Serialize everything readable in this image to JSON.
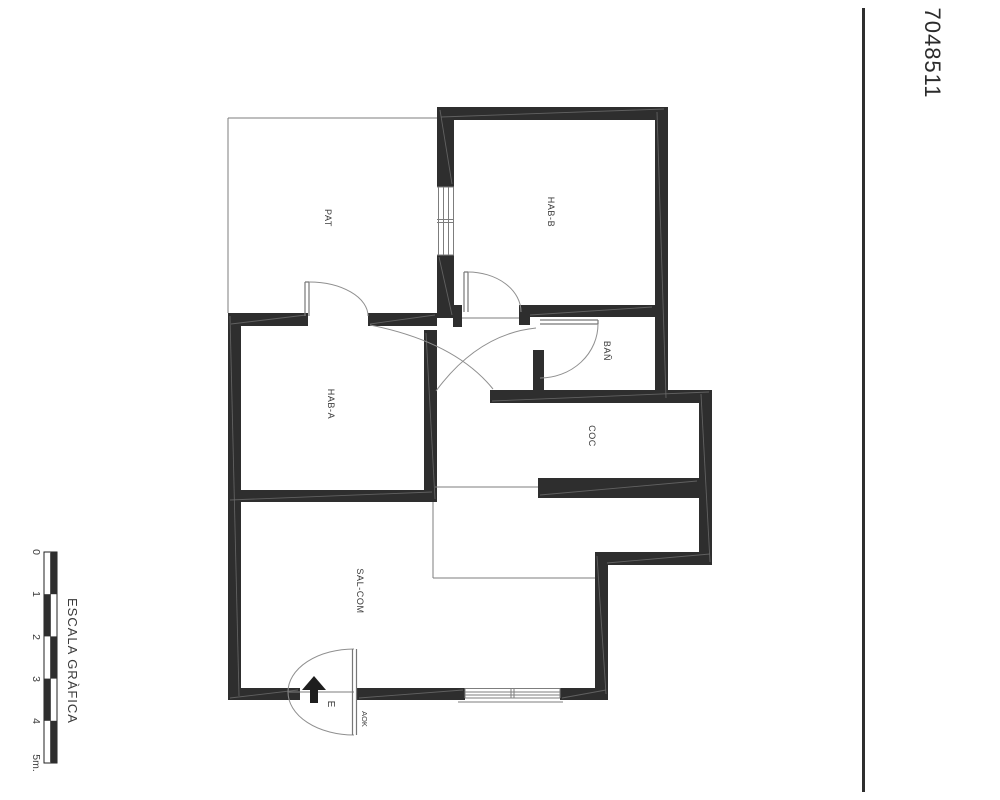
{
  "drawing_number": "7048511",
  "scale_bar": {
    "title": "ESCALA GRÀFICA",
    "ticks": [
      "0",
      "1",
      "2",
      "3",
      "4",
      "5m."
    ]
  },
  "rooms": {
    "pat": "PAT",
    "hab_b": "HAB-B",
    "ban": "BAÑ",
    "hab_a": "HAB-A",
    "coc": "COC",
    "sal_com": "SAL-COM"
  },
  "entrance": {
    "door_label": "E",
    "adjacent_label": "AOK"
  },
  "colors": {
    "wall": "#2e2e2e",
    "thin_line": "#7d7d7d",
    "text": "#3a3a3a",
    "background": "#ffffff"
  }
}
